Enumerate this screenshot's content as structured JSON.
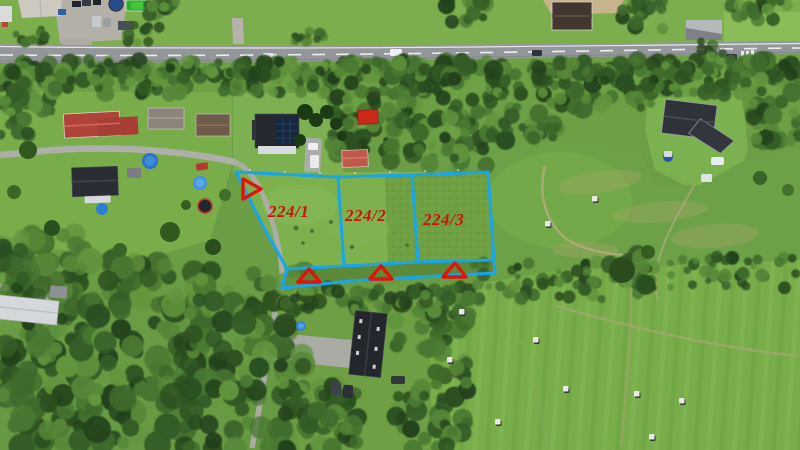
{
  "image": {
    "type": "aerial-drone-photo",
    "description": "Aerial view of three surveyed grassland building parcels outlined in blue along a rural road, with houses, gardens, woodland and mown meadows",
    "parcel_count": "3"
  },
  "annotations": {
    "boundary_color": "#17a5ec",
    "marker_color": "#e01408",
    "label_color": "#c81408",
    "parcels": [
      {
        "label": "224/1"
      },
      {
        "label": "224/2"
      },
      {
        "label": "224/3"
      }
    ]
  }
}
